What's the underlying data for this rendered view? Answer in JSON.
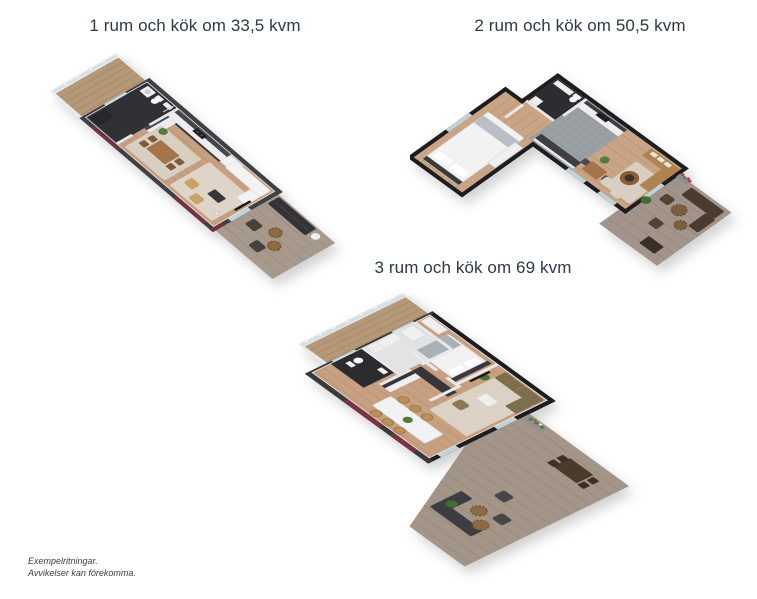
{
  "plans": [
    {
      "title": "1 rum och kök om 33,5 kvm"
    },
    {
      "title": "2 rum och kök om 50,5 kvm"
    },
    {
      "title": "3 rum och kök om 69 kvm"
    }
  ],
  "footnote": {
    "line1": "Exempelritningar.",
    "line2": "Avvikelser kan förekomma."
  },
  "palette": {
    "background": "#ffffff",
    "title_text": "#2d3945",
    "footnote_text": "#3b3b3b",
    "wood_floor": "#c7a081",
    "terrace_deck": "#a39588",
    "balcony_deck": "#b49878",
    "dark_wall": "#3f3f44",
    "black_wall": "#1d1d20",
    "white_wall": "#e9e9eb",
    "maroon_accent": "#6e3540",
    "glass": "#bfd3d9"
  }
}
